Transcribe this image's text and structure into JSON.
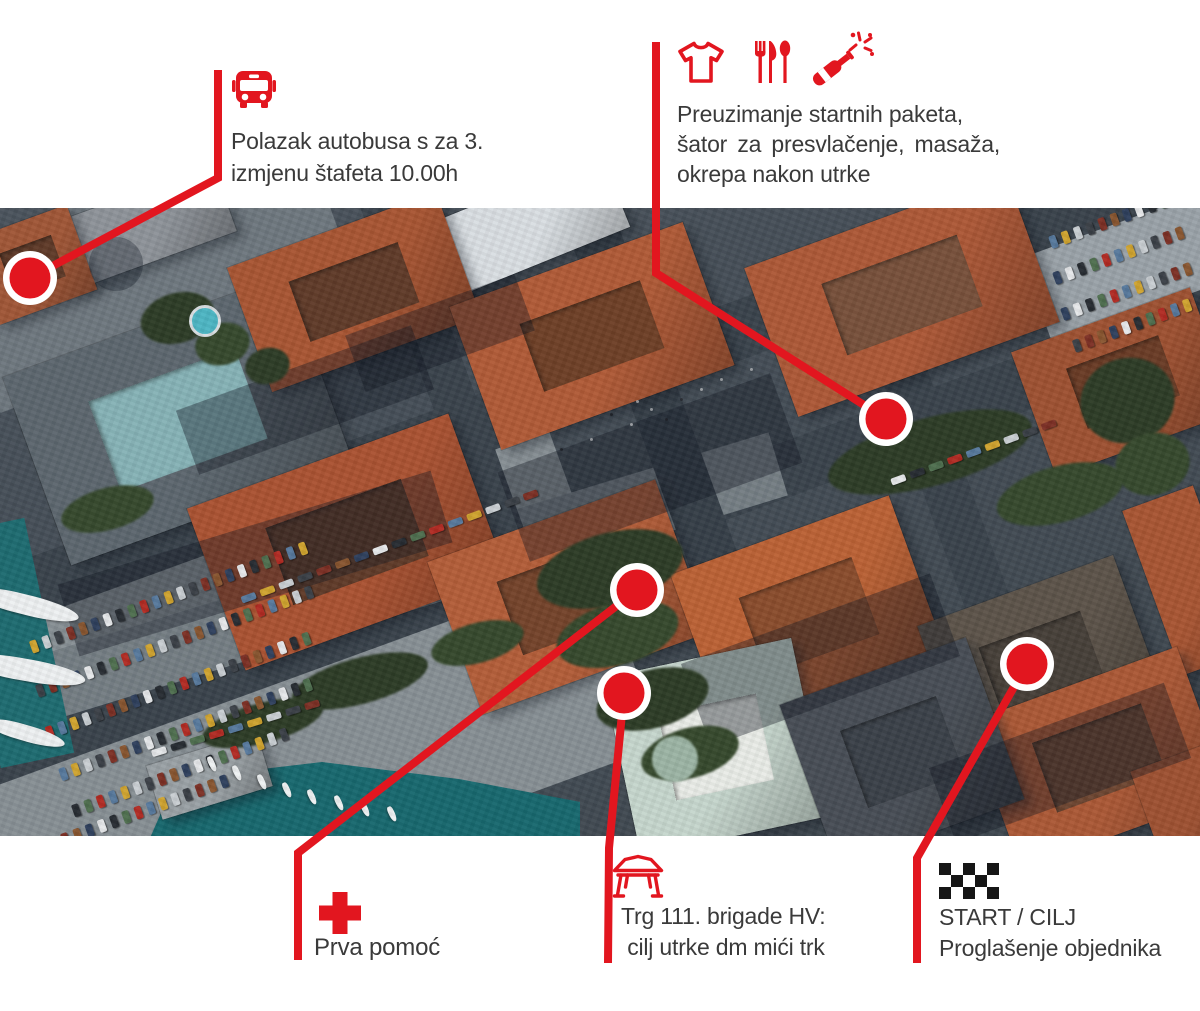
{
  "page": {
    "background": "#ffffff"
  },
  "colors": {
    "accent_red": "#e2161f",
    "text_dark": "#3a3a3a",
    "marker_ring": "#ffffff",
    "checker_black": "#161616",
    "water_teal": "#17686e",
    "roof_orange": "#ad5836"
  },
  "annotations": {
    "bus": {
      "icon": "bus-icon",
      "line1": "Polazak autobusa s za 3.",
      "line2": "izmjenu štafeta 10.00h"
    },
    "packets": {
      "icons": [
        "tshirt-icon",
        "cutlery-icon",
        "champagne-bottle-icon"
      ],
      "line1": "Preuzimanje startnih paketa,",
      "line2": "šator za presvlačenje, masaža,",
      "line3": "okrepa nakon utrke"
    },
    "first_aid": {
      "icon": "first-aid-cross-icon",
      "line1": "Prva pomoć"
    },
    "square": {
      "icon": "tent-icon",
      "line1": "Trg 111. brigade HV:",
      "line2": " cilj utrke dm mići trk"
    },
    "start_finish": {
      "icon": "checkered-flag-icon",
      "line1": "START / CILJ",
      "line2": "Proglašenje objednika"
    }
  },
  "map_markers": [
    {
      "name": "bus-departure-marker",
      "cx": 30,
      "cy": 278,
      "polyline": "218,70 218,178 30,278"
    },
    {
      "name": "start-packets-marker",
      "cx": 886,
      "cy": 419,
      "polyline": "656,42 656,273 886,419"
    },
    {
      "name": "first-aid-marker",
      "cx": 637,
      "cy": 590,
      "polyline": "637,590 298,853 298,960"
    },
    {
      "name": "square-finish-marker",
      "cx": 624,
      "cy": 693,
      "polyline": "624,693 609,848 608,963"
    },
    {
      "name": "start-finish-marker",
      "cx": 1027,
      "cy": 664,
      "polyline": "1027,664 917,858 917,963"
    }
  ]
}
